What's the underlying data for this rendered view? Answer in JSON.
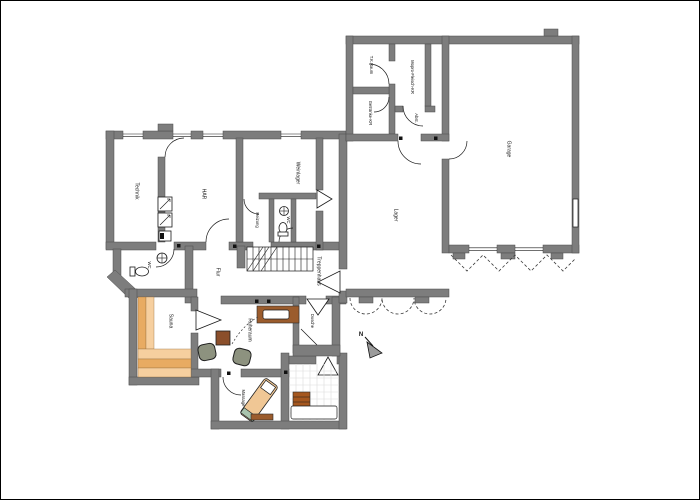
{
  "colors": {
    "wall": "#7d7d7d",
    "wellness": "#f6cf9f",
    "wellness_dark": "#e8ab62",
    "wood": "#9b5c2d",
    "table_wood": "#8b4f2b",
    "box_wood": "#a5571f",
    "chair": "#8d927f",
    "tile_line": "#dcdcdc"
  },
  "labels": {
    "technik": "Technik",
    "har": "HAR",
    "weinlager": "Weinlager",
    "heizung": "Heizung",
    "wc_upper": "WC",
    "wc_lower": "WC",
    "flur": "Flur",
    "treppenhaus": "Treppenhaus",
    "tk_raum": "T.K.Raum",
    "mopro": "Mopro-Fleisch-KR",
    "getraenke": "Getränke-KR",
    "abstell": "Abst.",
    "lager": "Lager",
    "garage": "Garage",
    "sauna": "Sauna",
    "ruheraum": "Ruheraum",
    "dusche": "Dusche",
    "massage": "Massage",
    "north": "N"
  }
}
